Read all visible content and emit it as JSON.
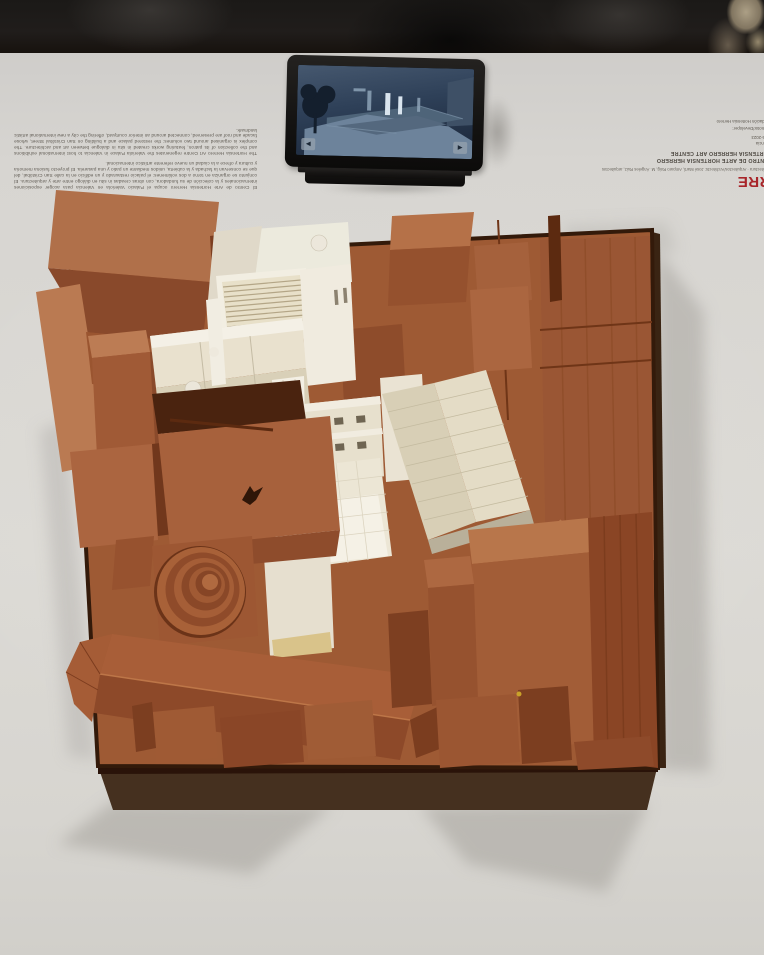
{
  "exhibit": {
    "tablet": {
      "prev_arrow": "◄",
      "next_arrow": "►"
    },
    "left_panel": {
      "paragraph_es": "El Centro de Arte Hortensia Herrero ocupa el Palacio Valeriola en Valencia para acoger exposiciones internacionales y la colección de su fundadora, con obras creadas in situ en diálogo entre arte y arquitectura. El conjunto se organiza en torno a dos volúmenes: el palacio restaurado y un edificio en la calle San Cristóbal, del que se conservan la fachada y la cubierta, unidos mediante un patio y una pasarela. El proyecto fusiona memoria y cultura y ofrece a la ciudad un nuevo referente artístico internacional.",
      "paragraph_en": "The Hortensia Herrero Art Centre regenerates the Valeriola Palace in Valencia to host international exhibitions and the collection of its patron, featuring works created in situ in dialogue between art and architecture. The complex is organised around two volumes: the restored palace and a building on San Cristóbal Street, whose facade and roof are preserved, connected around an interior courtyard, offering the city a new international artistic landmark."
    },
    "right_panel": {
      "studio": "ERRE",
      "architects_line": "arquitectura · Arquitectos/Architects: José Martí, Amparo Roig, M. Ángeles Ruiz, arquitectos",
      "title_es": "CENTRO DE ARTE HORTENSIA HERRERO",
      "title_en": "HORTENSIA HERRERO ART CENTRE",
      "location": "Valencia",
      "years": "2016-2023",
      "developer_label": "Promotor/Developer:",
      "developer_name": "Fundación Hortensia Herrero"
    },
    "colors": {
      "wood_mid": "#9e5a34",
      "wood_light": "#b97a4f",
      "wood_dark": "#8a4627",
      "model_white": "#f2eee3",
      "roof_cream": "#ddd5bd",
      "accent_red": "#a8252a",
      "table": "#d8d6d2",
      "wall": "#1b1917"
    }
  }
}
